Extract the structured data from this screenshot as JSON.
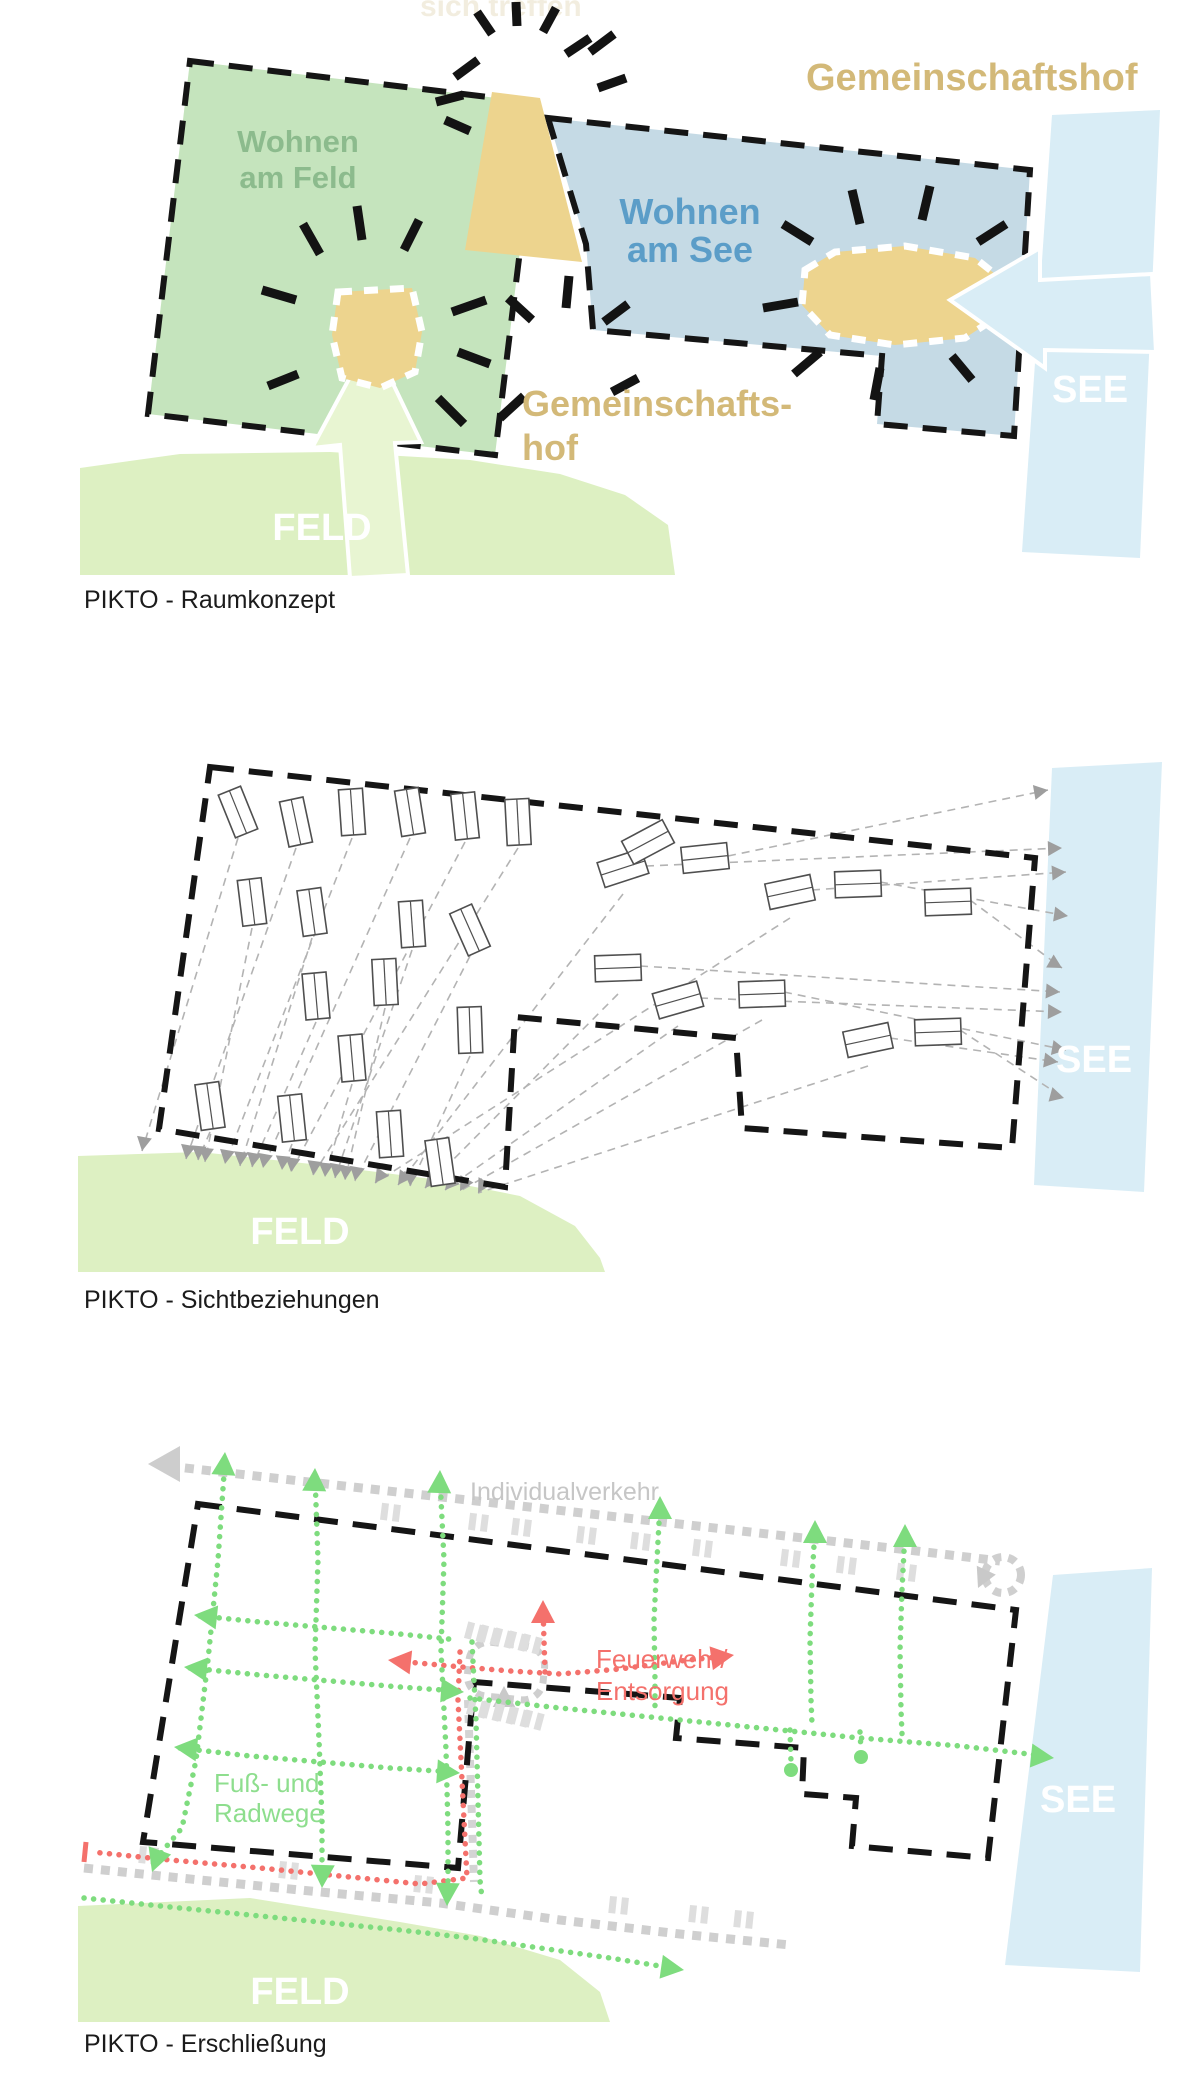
{
  "page": {
    "background": "#ffffff"
  },
  "figures": [
    {
      "id": "raumkonzept",
      "caption": "PIKTO - Raumkonzept",
      "labels": {
        "faint_top": "sich treffen",
        "wohnen_feld_line1": "Wohnen",
        "wohnen_feld_line2": "am Feld",
        "wohnen_see_line1": "Wohnen",
        "wohnen_see_line2": "am See",
        "gemeinschaftshof": "Gemeinschaftshof",
        "gemeinschaftshof_split_line1": "Gemeinschafts-",
        "gemeinschaftshof_split_line2": "hof",
        "feld": "FELD",
        "see": "SEE"
      }
    },
    {
      "id": "sichtbeziehungen",
      "caption": "PIKTO - Sichtbeziehungen",
      "labels": {
        "feld": "FELD",
        "see": "SEE"
      }
    },
    {
      "id": "erschliessung",
      "caption": "PIKTO - Erschließung",
      "labels": {
        "individualverkehr": "Individualverkehr",
        "feuerwehr_line1": "Feuerwehr/",
        "feuerwehr_line2": "Entsorgung",
        "fusswege_line1": "Fuß- und",
        "fusswege_line2": "Radwege",
        "feld": "FELD",
        "see": "SEE"
      }
    }
  ],
  "colors": {
    "boundary_black": "#151515",
    "zone_green_fill": "#c5e4bd",
    "zone_blue_fill": "#c5dae5",
    "field_green": "#ddf0c2",
    "lake_blue": "#d9edf6",
    "courtyard_tan": "#edd48e",
    "tan_text": "#d3b978",
    "green_text": "#8cbb8d",
    "blue_text": "#5b9dc8",
    "path_green": "#7edc7e",
    "route_red": "#f4716c",
    "road_gray": "#cfcfcf",
    "sight_gray": "#b3b3b3"
  }
}
